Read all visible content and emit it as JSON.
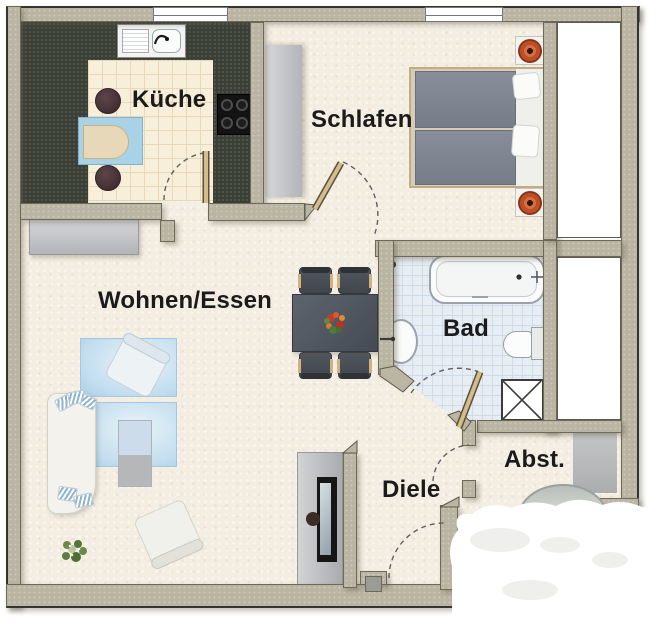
{
  "title": "Apartment floor plan",
  "rooms": {
    "kueche": {
      "label": "Küche"
    },
    "schlafen": {
      "label": "Schlafen"
    },
    "wohnen_essen": {
      "label": "Wohnen/Essen"
    },
    "bad": {
      "label": "Bad"
    },
    "diele": {
      "label": "Diele"
    },
    "abstellraum": {
      "label": "Abst."
    }
  },
  "colors": {
    "wall": "#b9b5a2",
    "wall_outline": "#35352f",
    "floor": "#f4ede1",
    "kitchen_counter": "#3b4036",
    "kitchen_tile": "#f8efdb",
    "bath_tile": "#e6edf3",
    "rug_blue": "#bddcf0",
    "bed_cover": "#7e8590",
    "lamp_orange": "#bc4f27",
    "closet_gray": "#c6c7ca",
    "window_white": "#ffffff",
    "label_text": "#1b1b1b"
  }
}
